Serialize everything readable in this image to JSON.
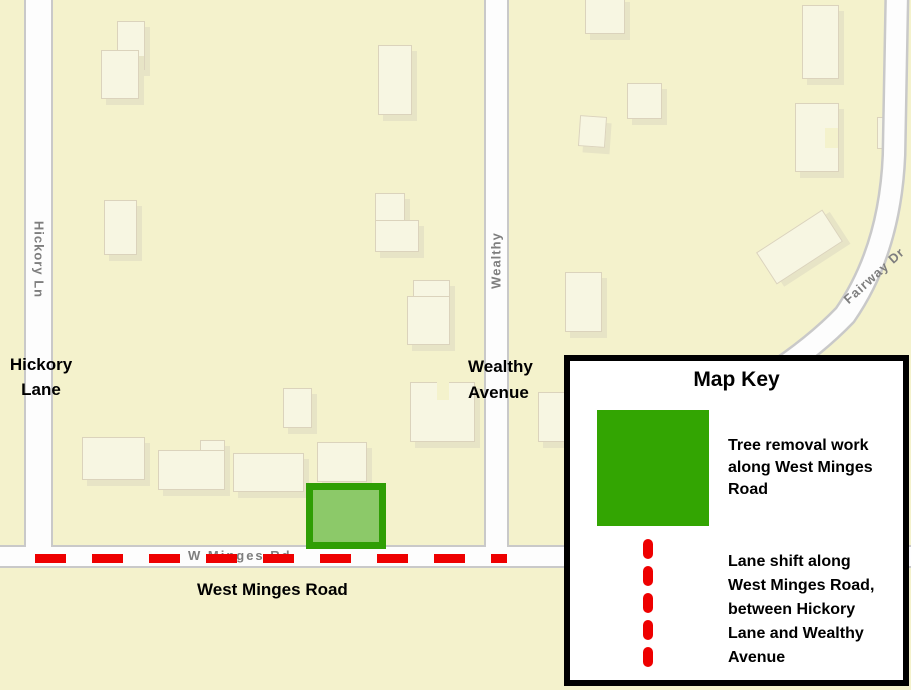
{
  "colors": {
    "map_bg": "#f4f2cc",
    "road_fill": "#fdfdfd",
    "road_casing": "#c9c9c9",
    "building_fill": "#f7f6e2",
    "highlight_green": "#33a502",
    "highlight_fill": "#8cc969",
    "lane_shift_red": "#ee0000",
    "road_label_gray": "#7e7e7e"
  },
  "map": {
    "road_names": {
      "hickory": "Hickory Ln",
      "wealthy": "Wealthy",
      "fairway": "Fairway Dr",
      "west_minges": "W Minges Rd"
    },
    "labels": {
      "hickory": {
        "lines": [
          "Hickory",
          "Lane"
        ]
      },
      "wealthy": {
        "lines": [
          "Wealthy",
          "Avenue"
        ]
      },
      "west_minges": "West Minges Road"
    }
  },
  "key": {
    "title": "Map Key",
    "items": [
      {
        "symbol": "green-square",
        "meaning": "Tree removal work along West Minges Road",
        "lines": [
          "Tree removal work",
          "along West Minges",
          "Road"
        ]
      },
      {
        "symbol": "red-dashed-line",
        "meaning": "Lane shift along West Minges Road, between Hickory Lane and Wealthy Avenue",
        "lines": [
          "Lane shift along",
          "West Minges Road,",
          "between Hickory",
          "Lane and Wealthy",
          "Avenue"
        ]
      }
    ]
  }
}
